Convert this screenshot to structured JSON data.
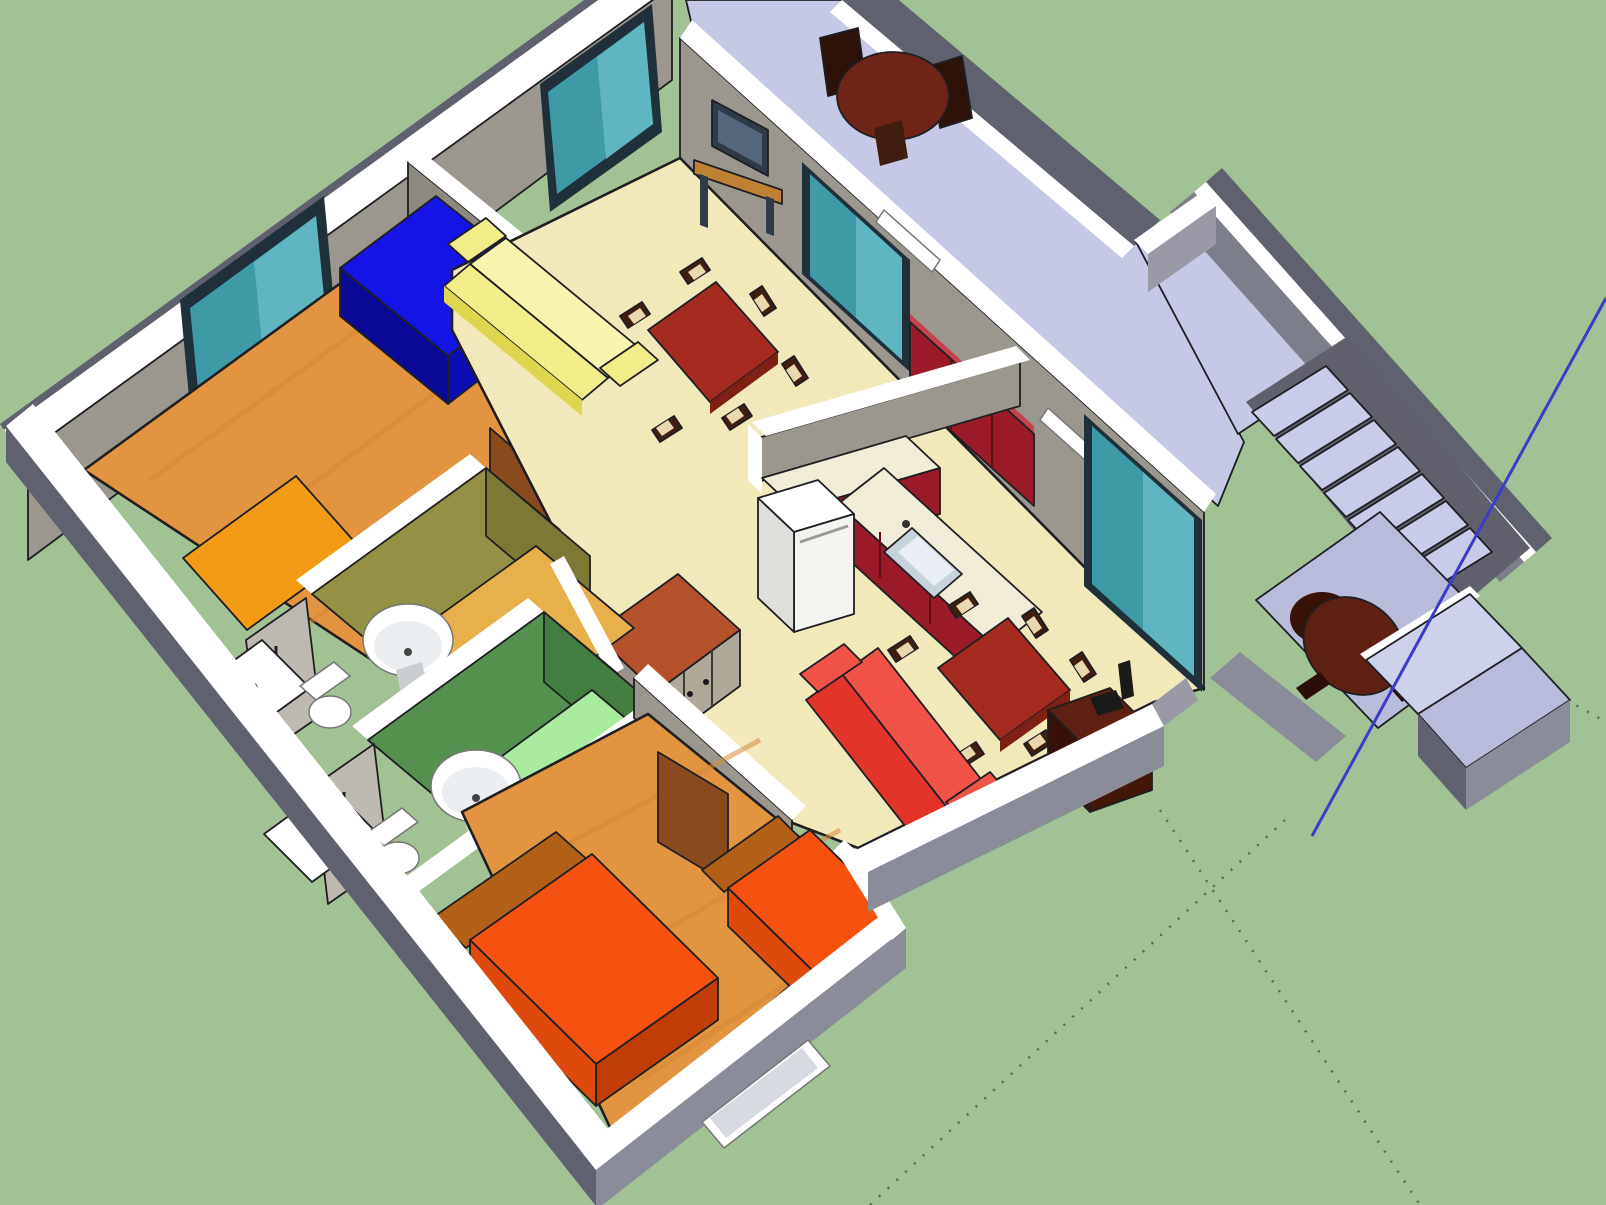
{
  "view": {
    "kind": "3d-model-render",
    "style": "sketchup-like-cutaway-floor-plan",
    "visible_text": "none",
    "description": "Isometric overhead cutaway 3D model of a single-storey house on a green ground plane, with drawing axis lines visible"
  },
  "colors": {
    "grass": "#a2c194",
    "outline": "#1f1f23",
    "capWhite": "#ffffff",
    "wallFace": "#9b978f",
    "wallFaceDark": "#8d8981",
    "wallOuterDark": "#5f626e",
    "wallOuterMid": "#8b8c99",
    "wallEndGray": "#9a9aa6",
    "hallFloor": "#c6c9e5",
    "hallFloorDim": "#b8bcda",
    "rampLight": "#ced1ea",
    "stairDark": "#5f606c",
    "stairWall": "#7c7e8a",
    "treadFill": "#c9cce8",
    "creamFloor": "#f2e9bb",
    "woodFloor": "#e29440",
    "woodStreak": "#d8893a",
    "rugOrange": "#f49b15",
    "blueBed": "#1414e6",
    "blueBedSide": "#0d0db6",
    "blueBedDark": "#0a0a96",
    "bath1Wall": "#949044",
    "bath1WallDark": "#7d7935",
    "bath1Floor": "#e7b04b",
    "bath2Wall": "#55924f",
    "bath2WallDark": "#447d41",
    "bath2Floor": "#a9ec9e",
    "fixtureShadow": "#c9ccd0",
    "showerGlass": "#bdb8b0",
    "showerFrame": "#4a4a48",
    "wardrobeTop": "#b4512a",
    "wardrobeDoor": "#b0a898",
    "wardrobeSide": "#9a9288",
    "doorBrown": "#8a4a1e",
    "tableRed": "#a52b1f",
    "tableRedDark": "#7f2015",
    "chairWood": "#3f1e10",
    "chairSeat": "#e9d8ad",
    "chairDarkWood": "#2c1208",
    "sofaYellow": "#f1ee8a",
    "sofaYellowLight": "#f7f4ad",
    "sofaYellowDark": "#ddd64e",
    "sofaRed": "#e23428",
    "sofaRedLight": "#f25347",
    "kitchenRed": "#9c1b2b",
    "kitchenRedLight": "#c4424e",
    "counterCream": "#f1ecd7",
    "sinkGray": "#c7d3da",
    "sinkLight": "#e8eef3",
    "fridgeFront": "#f3f3f0",
    "fridgeSide": "#dededa",
    "bedOrange": "#f4520e",
    "bedOrangeSide": "#dd4a0b",
    "bedOrangeDark": "#c03d08",
    "headboard": "#b26018",
    "cabinetDark": "#5e2012",
    "cabinetDarker": "#421609",
    "cabinetSide": "#38120a",
    "nearBlack": "#1a1a1a",
    "tvBody": "#2f3b49",
    "tvScreen": "#55657a",
    "standWood": "#bf8134",
    "windowTeal": "#3f9aa8",
    "windowTealLight": "#5fb5c0",
    "frameDark": "#20303a",
    "paneInner": "#d7dbe1",
    "verandaTable": "#6e2418",
    "axisBlue": "#3c3cca",
    "axisRed": "#c05a38",
    "dotGuide": "#50704e"
  },
  "scene": {
    "ground": "grass-field",
    "axes": {
      "red_axis": "short faint line at top edge",
      "blue_axis": "solid blue line from upper right down to entrance ramp",
      "ground_guides": "dotted guide lines radiating near entrance over the grass"
    },
    "building": {
      "storeys": 1,
      "rooms": [
        {
          "name": "bedroom-1",
          "floor": "orange-wood",
          "items": [
            "blue-double-bed",
            "orange-rug-bed",
            "teal-window",
            "open-wood-door"
          ]
        },
        {
          "name": "dining-room",
          "floor": "cream",
          "items": [
            "red-dining-table",
            "six-chairs",
            "yellow-sofa",
            "tv-on-stand",
            "teal-window",
            "sliding-glass-door"
          ]
        },
        {
          "name": "kitchen",
          "floor": "cream",
          "items": [
            "red-base-cabinets",
            "cream-countertop",
            "sink",
            "fridge",
            "red-wall-cabinets"
          ]
        },
        {
          "name": "family-dining-area",
          "floor": "cream",
          "items": [
            "red-dining-table",
            "six-chairs",
            "red-sofa",
            "dark-media-cabinet",
            "sliding-glass-door"
          ]
        },
        {
          "name": "bathroom-1",
          "walls": "olive",
          "floor": "amber",
          "items": [
            "wash-basin",
            "toilet",
            "shower-glass",
            "shower-tray"
          ]
        },
        {
          "name": "bathroom-2",
          "walls": "green",
          "floor": "light-green",
          "items": [
            "wash-basin",
            "toilet",
            "shower-glass",
            "shower-tray"
          ]
        },
        {
          "name": "bedroom-2",
          "floor": "orange-wood",
          "items": [
            "orange-double-bed",
            "orange-single-bed",
            "wood-door",
            "window"
          ]
        },
        {
          "name": "corridor",
          "floor": "cream",
          "items": [
            "wardrobe-cabinet"
          ]
        },
        {
          "name": "veranda-hallway",
          "floor": "lavender",
          "items": [
            "round-table-with-chairs",
            "door-thresholds",
            "wall-light-bars"
          ]
        },
        {
          "name": "staircase",
          "treads_visible": 7,
          "items": [
            "upper-landing",
            "steps",
            "entry-landing"
          ]
        },
        {
          "name": "entrance",
          "items": [
            "round-armchair",
            "two-step-ramp"
          ]
        }
      ]
    }
  }
}
